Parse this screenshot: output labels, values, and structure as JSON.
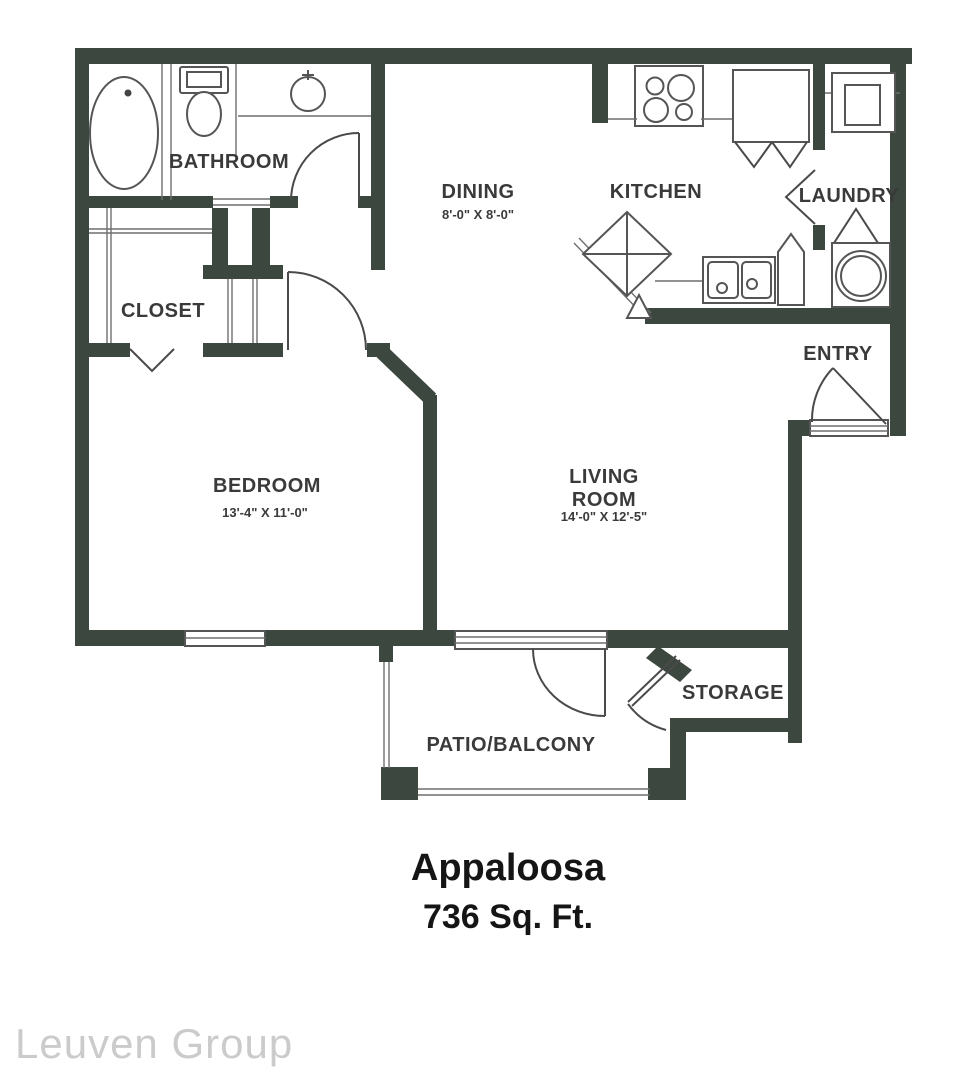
{
  "plan": {
    "rooms": {
      "bathroom": {
        "label": "BATHROOM"
      },
      "closet": {
        "label": "CLOSET"
      },
      "dining": {
        "label": "DINING",
        "dims": "8'-0\" X 8'-0\""
      },
      "kitchen": {
        "label": "KITCHEN"
      },
      "laundry": {
        "label": "LAUNDRY"
      },
      "entry": {
        "label": "ENTRY"
      },
      "bedroom": {
        "label": "BEDROOM",
        "dims": "13'-4\" X 11'-0\""
      },
      "living_room": {
        "label_line1": "LIVING",
        "label_line2": "ROOM",
        "dims": "14'-0\" X 12'-5\""
      },
      "storage": {
        "label": "STORAGE"
      },
      "patio": {
        "label": "PATIO/BALCONY"
      }
    },
    "title": "Appaloosa",
    "area": "736 Sq. Ft.",
    "watermark": "Leuven Group",
    "colors": {
      "wall": "#3c473f",
      "fixture_line": "#555555",
      "label_text": "#3a3a3a",
      "title_text": "#151515",
      "watermark_text": "#cbcbcb"
    }
  }
}
